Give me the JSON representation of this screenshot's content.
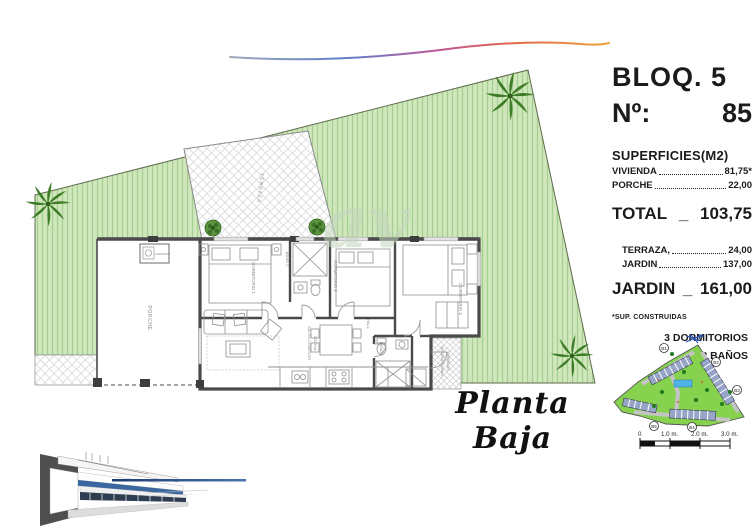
{
  "header": {
    "bloq": "BLOQ. 5",
    "num_label": "Nº:",
    "num_value": "85"
  },
  "surfaces": {
    "title": "SUPERFICIES(M2)",
    "vivienda_label": "VIVIENDA",
    "vivienda_value": "81,75*",
    "porche_label": "PORCHE",
    "porche_value": "22,00",
    "total_label": "TOTAL",
    "total_sep": "_",
    "total_value": "103,75",
    "terraza_label": "TERRAZA,",
    "terraza_value": "24,00",
    "jardin_row_label": "JARDIN",
    "jardin_row_value": "137,00",
    "jardin_total_label": "JARDIN",
    "jardin_total_sep": "_",
    "jardin_total_value": "161,00",
    "footnote": "*SUP. CONSTRUIDAS",
    "feature_1": "3 DORMITORIOS",
    "feature_2": "2 BAÑOS"
  },
  "floorplan": {
    "caption": "Planta Baja",
    "rooms": {
      "terraza": "TERRAZA",
      "porche": "PORCHE",
      "lavadero": "LAVADERO",
      "dormitorio1": "DORMITORIO 1",
      "bano2": "BAÑO 2",
      "dormitorio2": "DORMITORIO 2",
      "dormitorio3": "DORMITORIO 3",
      "hall": "HALL",
      "salon_line1": "SALON-COMEDOR",
      "salon_line2": "COCINA",
      "bano1": "BAÑO 1",
      "acceso_line1": "ACCESO COMUN",
      "acceso_line2": "VIVIENDAS"
    }
  },
  "watermark": "av",
  "site_map": {
    "labels": [
      "B1",
      "B2",
      "B3",
      "B4",
      "B5"
    ]
  },
  "scale_bar": {
    "t0": "0",
    "t1": "1.0 m.",
    "t2": "2.0 m.",
    "t3": "3.0 m."
  },
  "colors": {
    "lawn": "#cfe7bb",
    "lawn_stripe": "#a6cf92",
    "palm": "#3e7c27",
    "wall": "#4a4a4a",
    "swoosh_blue": "#5f7fd0",
    "swoosh_orange": "#eea43e",
    "render_blue": "#3a67a0",
    "map_green": "#86d24f"
  }
}
